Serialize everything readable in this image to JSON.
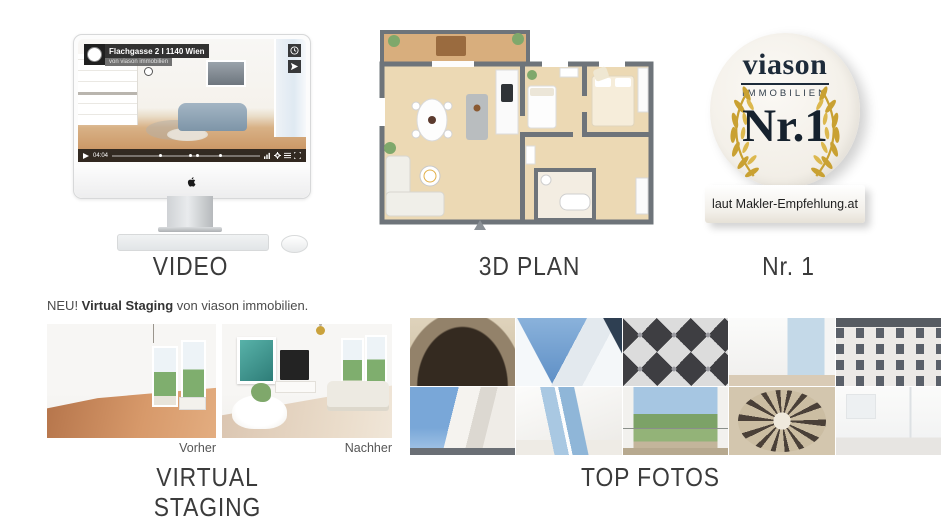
{
  "canvas": {
    "width": 950,
    "height": 529,
    "background": "#ffffff"
  },
  "colors": {
    "gold": "#c9a132",
    "navy": "#1d2b3a",
    "wood_floor": "#ecd9b4",
    "wall_gray": "#6e747a",
    "heading_text": "#3b3b3b",
    "sky_blue": "#7aa7d9"
  },
  "sections": {
    "video": {
      "label": "VIDEO",
      "player": {
        "title": "Flachgasse 2 I 1140 Wien",
        "subtitle": "von viason immobilien",
        "time": "04:04",
        "icons": {
          "channel_logo": "viason-circle-logo",
          "watch_later": "clock-icon",
          "share": "paper-plane-icon",
          "play": "play-triangle-icon",
          "volume": "volume-bars-icon",
          "settings": "gear-icon",
          "playlist": "list-icon",
          "fullscreen": "expand-icon"
        }
      },
      "device": "imac-with-keyboard-and-mouse"
    },
    "plan": {
      "label": "3D PLAN",
      "illustration": "3d-floor-plan-two-bedroom-apartment"
    },
    "award": {
      "label": "Nr. 1",
      "badge": {
        "brand": "viason",
        "brand_sub": "IMMOBILIEN",
        "rank": "Nr.1",
        "caption": "laut Makler-Empfehlung.at",
        "ornament": "gold-laurel-wreath"
      }
    },
    "staging": {
      "label": "VIRTUAL STAGING",
      "intro": {
        "prefix": "NEU! ",
        "bold": "Virtual Staging",
        "suffix": " von viason immobilien."
      },
      "before_label": "Vorher",
      "after_label": "Nachher"
    },
    "photos": {
      "label": "TOP FOTOS",
      "items": [
        {
          "name": "ornate-entrance-gate"
        },
        {
          "name": "modern-white-architecture"
        },
        {
          "name": "ornamental-floor-tiles"
        },
        {
          "name": "bright-interior-window"
        },
        {
          "name": "classic-viennese-facade"
        },
        {
          "name": "corner-building-blue-sky"
        },
        {
          "name": "attic-skylights"
        },
        {
          "name": "balcony-outlook"
        },
        {
          "name": "spiral-staircase"
        },
        {
          "name": "white-bathroom"
        }
      ]
    }
  }
}
